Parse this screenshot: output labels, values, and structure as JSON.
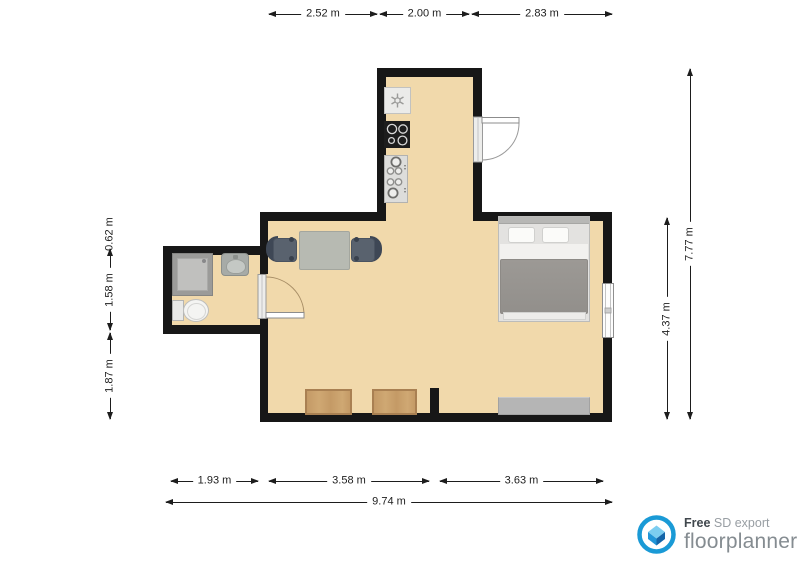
{
  "colors": {
    "floor": "#f1d9ab",
    "wall": "#171717",
    "dim": "#1d1d1d",
    "table": "#b7bab2",
    "chair": "#59626e",
    "chair_back": "#3e4755",
    "duvet": "#9c9995",
    "gray_furniture": "#b5b5b5",
    "wood": "#c49a66",
    "brand_blue": "#1a9ad6",
    "brand_gray": "#858c91"
  },
  "dimensions": {
    "top": [
      {
        "label": "2.52 m"
      },
      {
        "label": "2.00 m"
      },
      {
        "label": "2.83 m"
      }
    ],
    "left": [
      {
        "label": "0.62 m"
      },
      {
        "label": "1.58 m"
      },
      {
        "label": "1.87 m"
      }
    ],
    "right": [
      {
        "label": "7.77 m"
      },
      {
        "label": "4.37 m"
      }
    ],
    "bottom": [
      {
        "label": "1.93 m"
      },
      {
        "label": "3.58 m"
      },
      {
        "label": "3.63 m"
      }
    ],
    "total": {
      "label": "9.74 m"
    }
  },
  "furniture": {
    "kitchen": [
      "dishwasher-icon",
      "cooktop-icon",
      "gas-hob-icon"
    ],
    "dining": [
      "dining-table",
      "chair-left",
      "chair-right"
    ],
    "bathroom": [
      "shower",
      "washbasin",
      "toilet"
    ],
    "bedroom": [
      "double-bed",
      "window",
      "dresser"
    ],
    "living": [
      "wood-cabinet-left",
      "wood-cabinet-right"
    ],
    "doors": [
      "entry-door",
      "bathroom-door"
    ]
  },
  "footer": {
    "free": "Free",
    "export_type": " SD export",
    "brand": "floorplanner"
  }
}
